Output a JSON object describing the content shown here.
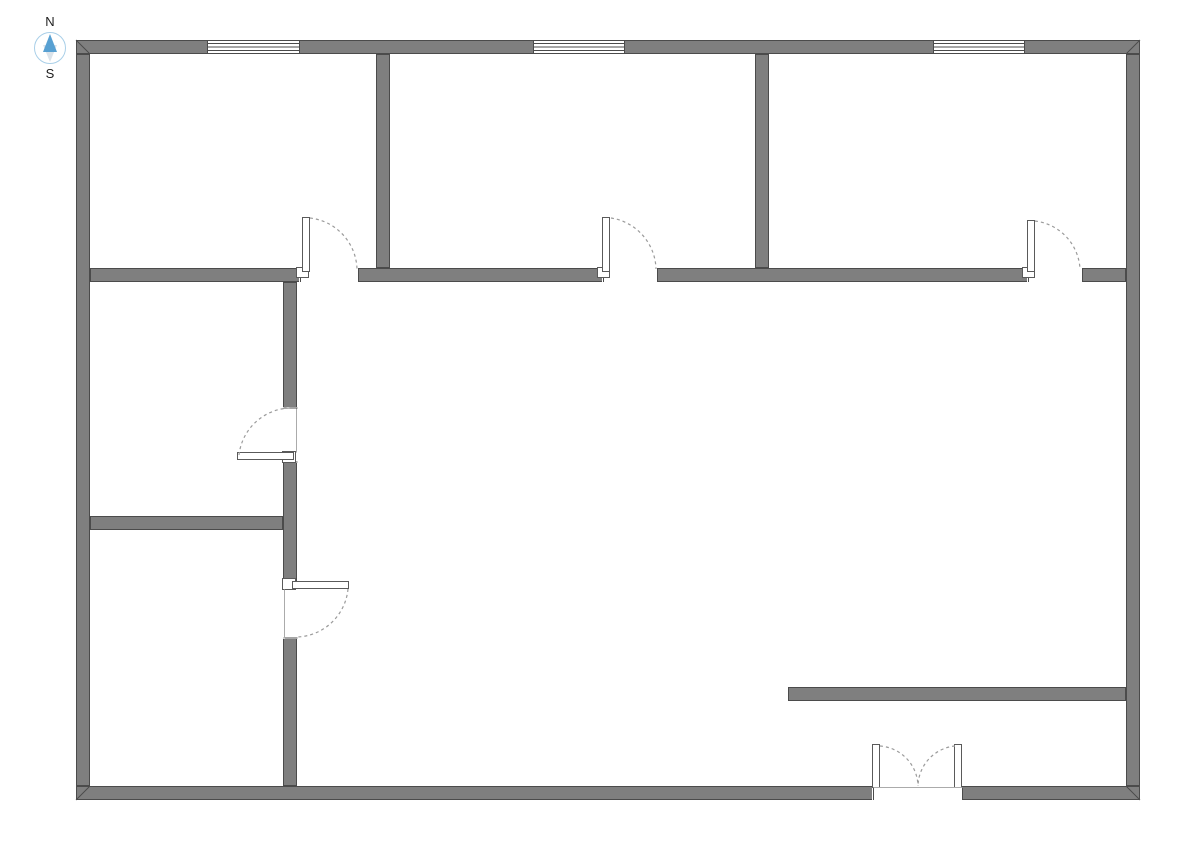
{
  "compass": {
    "north_label": "N",
    "south_label": "S",
    "circle_color": "#a9cfe8",
    "north_color": "#58a0d2",
    "south_color": "#dbe3ea",
    "label_color": "#1f1f1f"
  },
  "plan": {
    "background": "#ffffff",
    "colors": {
      "wall_fill": "#7f7f7f",
      "wall_stroke": "#4b4b4b",
      "opening_fill": "#ffffff",
      "fixture_fill": "#ffffff",
      "fixture_stroke": "#5a5a5a",
      "arc_color": "#9b9b9b",
      "threshold_color": "#ababab"
    },
    "walls": [
      {
        "name": "wall-exterior-top",
        "x": 76,
        "y": 40,
        "w": 1064,
        "h": 14
      },
      {
        "name": "wall-exterior-left",
        "x": 76,
        "y": 54,
        "w": 14,
        "h": 732
      },
      {
        "name": "wall-exterior-right",
        "x": 1126,
        "y": 54,
        "w": 14,
        "h": 732
      },
      {
        "name": "wall-exterior-bottom",
        "x": 76,
        "y": 786,
        "w": 1064,
        "h": 14
      },
      {
        "name": "wall-divider-room1-room2",
        "x": 376,
        "y": 54,
        "w": 14,
        "h": 214
      },
      {
        "name": "wall-divider-room2-room3",
        "x": 755,
        "y": 54,
        "w": 14,
        "h": 214
      },
      {
        "name": "wall-middle-horizontal",
        "x": 90,
        "y": 268,
        "w": 1036,
        "h": 14
      },
      {
        "name": "wall-vertical-left-rooms",
        "x": 283,
        "y": 282,
        "w": 14,
        "h": 504
      },
      {
        "name": "wall-divider-left-rooms",
        "x": 90,
        "y": 516,
        "w": 193,
        "h": 14
      },
      {
        "name": "wall-partial-bottom-right",
        "x": 788,
        "y": 687,
        "w": 338,
        "h": 14
      }
    ],
    "miters": [
      {
        "x1": 76,
        "y1": 40,
        "x2": 90,
        "y2": 54
      },
      {
        "x1": 1140,
        "y1": 40,
        "x2": 1126,
        "y2": 54
      },
      {
        "x1": 76,
        "y1": 800,
        "x2": 90,
        "y2": 786
      },
      {
        "x1": 1140,
        "y1": 800,
        "x2": 1126,
        "y2": 786
      }
    ],
    "openings": [
      {
        "x": 299,
        "y": 267,
        "w": 60,
        "h": 16
      },
      {
        "x": 602,
        "y": 267,
        "w": 56,
        "h": 16
      },
      {
        "x": 1027,
        "y": 267,
        "w": 56,
        "h": 16
      },
      {
        "x": 282,
        "y": 407,
        "w": 16,
        "h": 56
      },
      {
        "x": 282,
        "y": 583,
        "w": 16,
        "h": 56
      },
      {
        "x": 872,
        "y": 785,
        "w": 91,
        "h": 16
      }
    ],
    "endcaps": [
      {
        "x1": 300,
        "y1": 268,
        "x2": 300,
        "y2": 282
      },
      {
        "x1": 358,
        "y1": 268,
        "x2": 358,
        "y2": 282
      },
      {
        "x1": 603,
        "y1": 268,
        "x2": 603,
        "y2": 282
      },
      {
        "x1": 657,
        "y1": 268,
        "x2": 657,
        "y2": 282
      },
      {
        "x1": 1028,
        "y1": 268,
        "x2": 1028,
        "y2": 282
      },
      {
        "x1": 1082,
        "y1": 268,
        "x2": 1082,
        "y2": 282
      },
      {
        "x1": 283,
        "y1": 408,
        "x2": 297,
        "y2": 408
      },
      {
        "x1": 283,
        "y1": 462,
        "x2": 297,
        "y2": 462
      },
      {
        "x1": 283,
        "y1": 584,
        "x2": 297,
        "y2": 584
      },
      {
        "x1": 283,
        "y1": 638,
        "x2": 297,
        "y2": 638
      },
      {
        "x1": 873,
        "y1": 786,
        "x2": 873,
        "y2": 800
      },
      {
        "x1": 962,
        "y1": 786,
        "x2": 962,
        "y2": 800
      }
    ],
    "windows": [
      {
        "x": 207,
        "y": 40,
        "w": 93,
        "h": 14
      },
      {
        "x": 533,
        "y": 40,
        "w": 92,
        "h": 14
      },
      {
        "x": 933,
        "y": 40,
        "w": 92,
        "h": 14
      }
    ],
    "jambs": [
      {
        "x": 296,
        "y": 267,
        "w": 13,
        "h": 11
      },
      {
        "x": 597,
        "y": 267,
        "w": 13,
        "h": 11
      },
      {
        "x": 1022,
        "y": 267,
        "w": 13,
        "h": 11
      },
      {
        "x": 282,
        "y": 451,
        "w": 14,
        "h": 12
      },
      {
        "x": 282,
        "y": 578,
        "w": 14,
        "h": 12
      }
    ],
    "door_leaves": [
      {
        "x": 302,
        "y": 217,
        "w": 8,
        "h": 55
      },
      {
        "x": 602,
        "y": 217,
        "w": 8,
        "h": 55
      },
      {
        "x": 1027,
        "y": 220,
        "w": 8,
        "h": 52
      },
      {
        "x": 237,
        "y": 452,
        "w": 57,
        "h": 8
      },
      {
        "x": 292,
        "y": 581,
        "w": 57,
        "h": 8
      },
      {
        "x": 872,
        "y": 744,
        "w": 8,
        "h": 44
      },
      {
        "x": 954,
        "y": 744,
        "w": 8,
        "h": 44
      }
    ],
    "thresholds": [
      {
        "x1": 296,
        "y1": 408,
        "x2": 296,
        "y2": 452
      },
      {
        "x1": 284,
        "y1": 589,
        "x2": 284,
        "y2": 638
      },
      {
        "x1": 873,
        "y1": 787,
        "x2": 962,
        "y2": 787
      }
    ],
    "door_arcs": [
      {
        "d": "M 310 218 A 53 53 0 0 1 357 269"
      },
      {
        "d": "M 611 218 A 53 53 0 0 1 656 269"
      },
      {
        "d": "M 1035 221 A 51 51 0 0 1 1080 269"
      },
      {
        "d": "M 239 455 A 53 53 0 0 1 290 408"
      },
      {
        "d": "M 348 589 A 53 53 0 0 1 297 637"
      },
      {
        "d": "M 880 746 A 41 41 0 0 1 918 786"
      },
      {
        "d": "M 955 746 A 41 41 0 0 0 918 786"
      }
    ]
  }
}
